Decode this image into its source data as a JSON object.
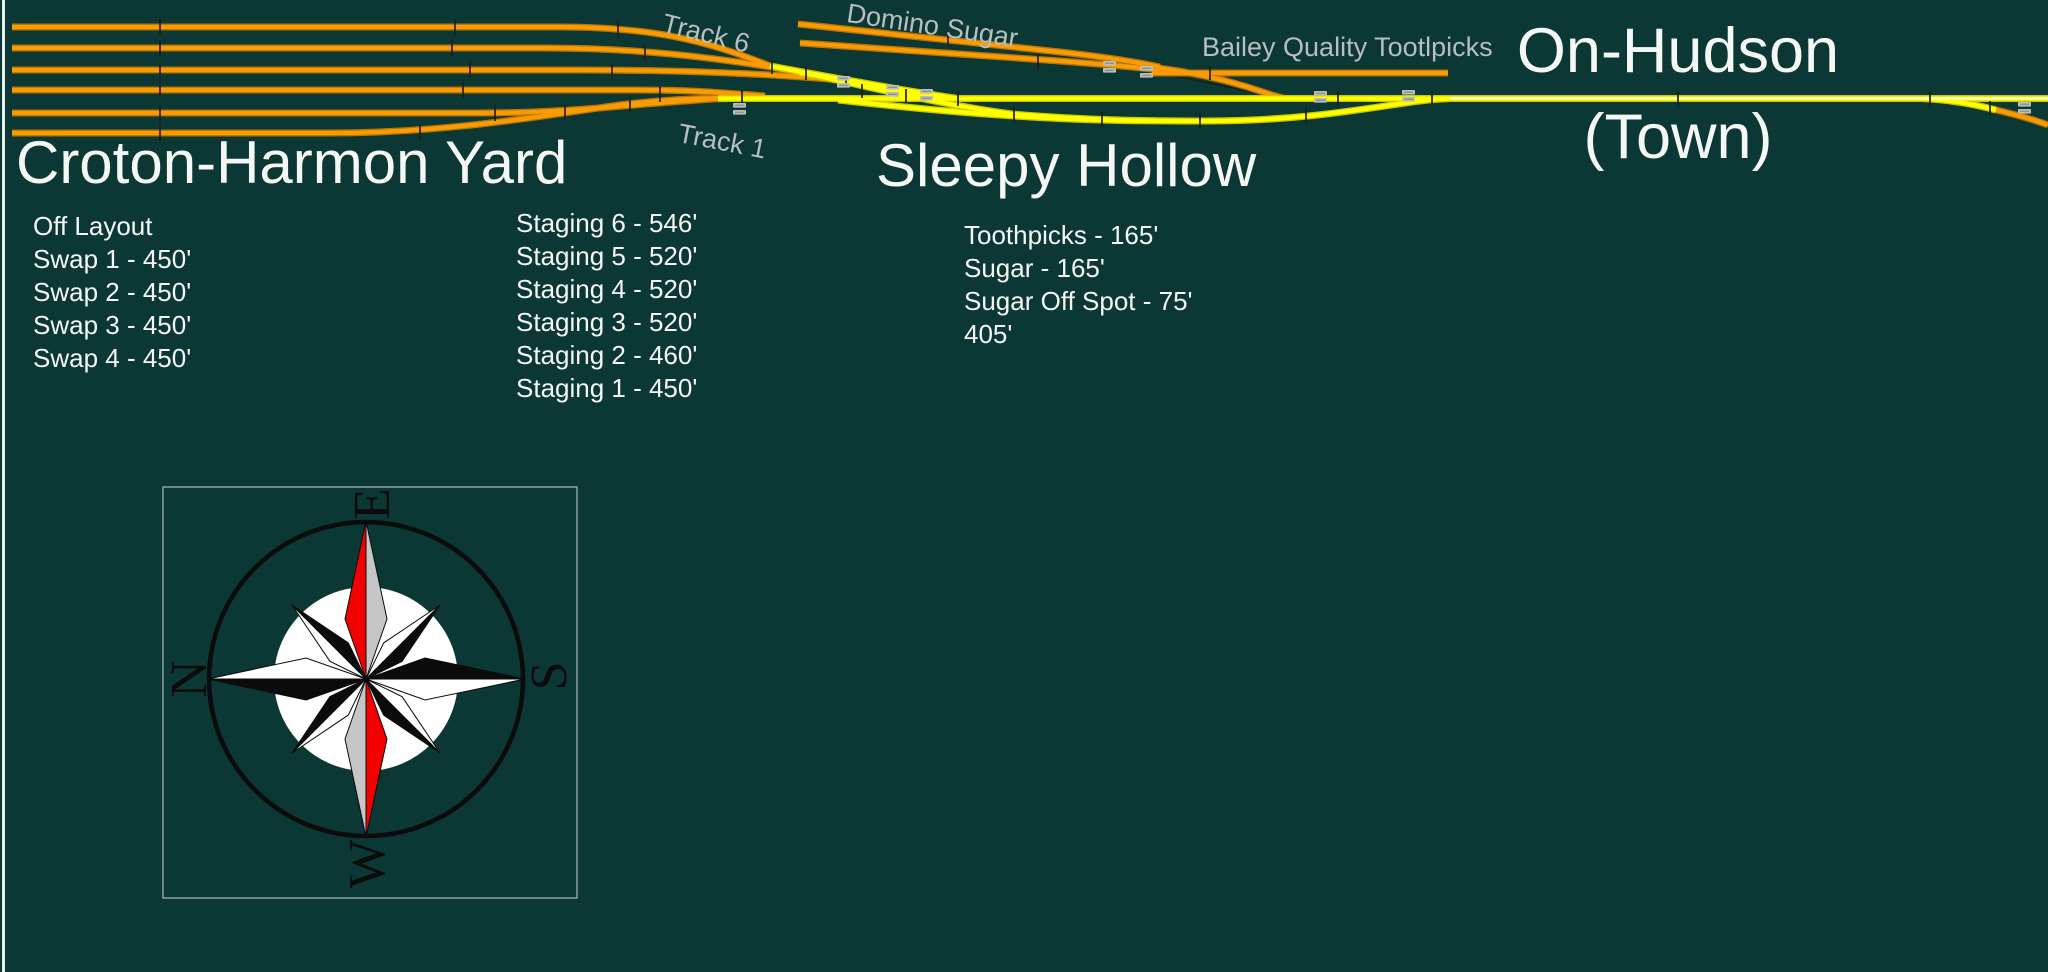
{
  "colors": {
    "bg": "#0b3734",
    "page_border": "#e9efee",
    "track_orange": "#f89b07",
    "track_orange_edge": "#b97500",
    "track_yellow": "#ffff00",
    "track_yellow_edge": "#c9c900",
    "track_yellow_pale": "#ffffc4",
    "label_gray": "#b7bfbe",
    "text_white": "#f5f7f5",
    "tick": "#231f0c",
    "tag_fill": "#b9beb9",
    "tag_line": "#85908c",
    "compass_red": "#f10000",
    "compass_gray": "#c6c6c6",
    "compass_black": "#0b0b0b",
    "compass_box_border": "#9fb3af"
  },
  "track_labels": {
    "track6": "Track 6",
    "track1": "Track 1",
    "domino_sugar": "Domino Sugar",
    "bailey": "Bailey Quality Tootlpicks"
  },
  "croton": {
    "title": "Croton-Harmon Yard",
    "tracks_left": [
      "Off Layout",
      "Swap 1 - 450'",
      "Swap 2 - 450'",
      "Swap 3 - 450'",
      "Swap 4 - 450'"
    ],
    "tracks_right": [
      "Staging 6 - 546'",
      "Staging 5 - 520'",
      "Staging 4 - 520'",
      "Staging 3 - 520'",
      "Staging 2 - 460'",
      "Staging 1 - 450'"
    ]
  },
  "sleepy_hollow": {
    "title": "Sleepy Hollow",
    "tracks": [
      "Toothpicks - 165'",
      "Sugar - 165'",
      "Sugar Off Spot - 75'",
      "405'"
    ]
  },
  "on_hudson": {
    "line1": "On-Hudson",
    "line2": "(Town)"
  },
  "compass": {
    "top": "E",
    "left": "N",
    "right": "S",
    "bottom": "W"
  }
}
